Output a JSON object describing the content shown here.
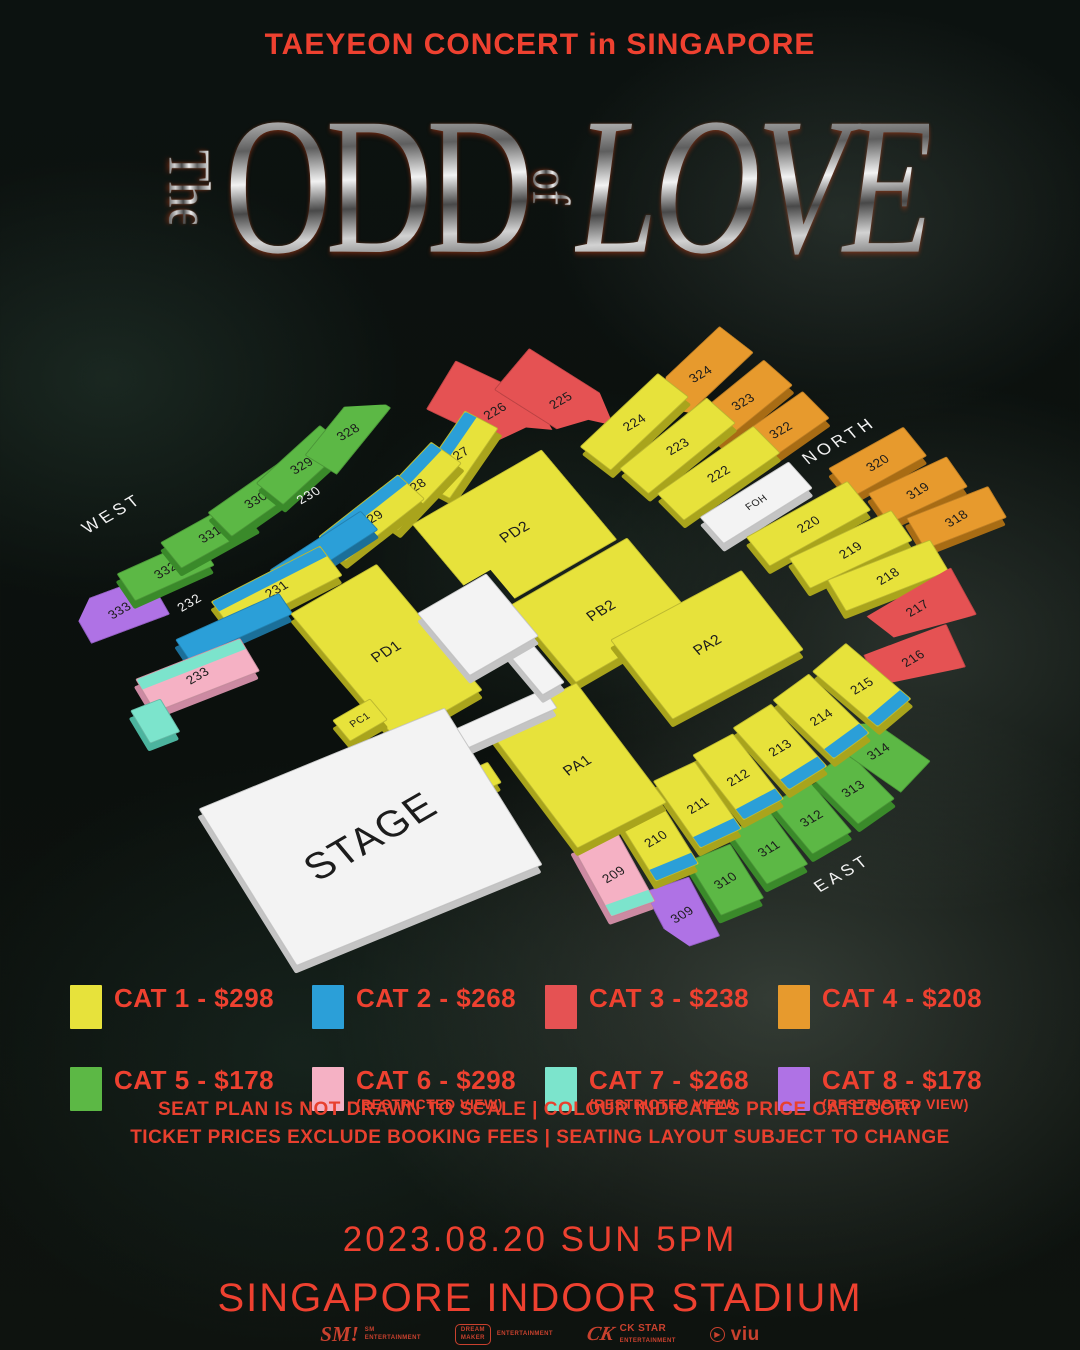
{
  "header": {
    "title": "TAEYEON CONCERT in SINGAPORE",
    "logo": {
      "the": "The",
      "odd": "ODD",
      "of": "of",
      "love": "LOVE"
    }
  },
  "map": {
    "compass": {
      "west": "WEST",
      "north": "NORTH",
      "east": "EAST"
    },
    "floating_labels": [
      {
        "text": "WEST",
        "x": -245,
        "y": -335,
        "size": 17,
        "ls": 4
      },
      {
        "text": "NORTH",
        "x": 368,
        "y": -30,
        "size": 17,
        "ls": 4
      },
      {
        "text": "EAST",
        "x": 88,
        "y": 352,
        "size": 17,
        "ls": 4
      },
      {
        "text": "230",
        "x": -80,
        "y": -252,
        "size": 13,
        "ls": 1
      },
      {
        "text": "232",
        "x": -243,
        "y": -218,
        "size": 13,
        "ls": 1
      }
    ],
    "sections": [
      {
        "id": "333",
        "label": "333",
        "cat": "8",
        "x": -302,
        "y": -247,
        "w": 82,
        "h": 46,
        "rot": 10,
        "clip": "cut-tl"
      },
      {
        "id": "332",
        "label": "332",
        "cat": "5",
        "x": -240,
        "y": -259,
        "w": 86,
        "h": 34,
        "rot": 6
      },
      {
        "id": "331",
        "label": "331",
        "cat": "5",
        "x": -182,
        "y": -268,
        "w": 90,
        "h": 34,
        "rot": 1
      },
      {
        "id": "330",
        "label": "330",
        "cat": "5",
        "x": -124,
        "y": -275,
        "w": 90,
        "h": 34,
        "rot": -5
      },
      {
        "id": "329",
        "label": "329",
        "cat": "5",
        "x": -66,
        "y": -282,
        "w": 90,
        "h": 34,
        "rot": -12
      },
      {
        "id": "328",
        "label": "328",
        "cat": "5",
        "x": -8,
        "y": -288,
        "w": 92,
        "h": 36,
        "rot": -20,
        "clip": "taper-r"
      },
      {
        "id": "324",
        "label": "324",
        "cat": "4",
        "x": 304,
        "y": -160,
        "w": 104,
        "h": 42,
        "rot": -13,
        "clip": "pent-l"
      },
      {
        "id": "323",
        "label": "323",
        "cat": "4",
        "x": 319,
        "y": -114,
        "w": 94,
        "h": 38,
        "rot": -9
      },
      {
        "id": "322",
        "label": "322",
        "cat": "4",
        "x": 330,
        "y": -70,
        "w": 88,
        "h": 38,
        "rot": -5
      },
      {
        "id": "320",
        "label": "320",
        "cat": "4",
        "x": 384,
        "y": 8,
        "w": 86,
        "h": 38,
        "rot": 1
      },
      {
        "id": "319",
        "label": "319",
        "cat": "4",
        "x": 397,
        "y": 53,
        "w": 86,
        "h": 38,
        "rot": 5
      },
      {
        "id": "318",
        "label": "318",
        "cat": "4",
        "x": 409,
        "y": 97,
        "w": 86,
        "h": 38,
        "rot": 9
      },
      {
        "id": "226",
        "label": "226",
        "cat": "3",
        "x": 120,
        "y": -232,
        "w": 62,
        "h": 112,
        "rot": -27,
        "clip": "tip-b"
      },
      {
        "id": "225",
        "label": "225",
        "cat": "3",
        "x": 178,
        "y": -208,
        "w": 58,
        "h": 110,
        "rot": -19,
        "clip": "tip-b"
      },
      {
        "id": "224",
        "label": "224",
        "cat": "1",
        "x": 221,
        "y": -151,
        "w": 112,
        "h": 38,
        "rot": -13
      },
      {
        "id": "223",
        "label": "223",
        "cat": "1",
        "x": 239,
        "y": -108,
        "w": 116,
        "h": 38,
        "rot": -9
      },
      {
        "id": "222",
        "label": "222",
        "cat": "1",
        "x": 253,
        "y": -63,
        "w": 120,
        "h": 38,
        "rot": -5
      },
      {
        "id": "FOH",
        "label": "FOH",
        "cat": "white",
        "x": 263,
        "y": -18,
        "w": 106,
        "h": 36,
        "rot": -2,
        "fs": 10
      },
      {
        "id": "220",
        "label": "220",
        "cat": "1",
        "x": 290,
        "y": 27,
        "w": 116,
        "h": 38,
        "rot": 1
      },
      {
        "id": "219",
        "label": "219",
        "cat": "1",
        "x": 306,
        "y": 71,
        "w": 112,
        "h": 38,
        "rot": 5
      },
      {
        "id": "218",
        "label": "218",
        "cat": "1",
        "x": 318,
        "y": 113,
        "w": 108,
        "h": 38,
        "rot": 9
      },
      {
        "id": "227",
        "label": "227",
        "cat": "1",
        "x": 62,
        "y": -212,
        "w": 92,
        "h": 36,
        "rot": -24,
        "band": "top",
        "bandCat": "2"
      },
      {
        "id": "228",
        "label": "228",
        "cat": "1",
        "x": 8,
        "y": -206,
        "w": 98,
        "h": 36,
        "rot": -16,
        "band": "top",
        "bandCat": "2"
      },
      {
        "id": "229",
        "label": "229",
        "cat": "1",
        "x": -46,
        "y": -200,
        "w": 104,
        "h": 36,
        "rot": -8,
        "band": "top",
        "bandCat": "2"
      },
      {
        "id": "230",
        "cat": "2",
        "x": -104,
        "y": -196,
        "w": 110,
        "h": 26,
        "rot": -3
      },
      {
        "id": "231",
        "label": "231",
        "cat": "1",
        "x": -166,
        "y": -186,
        "w": 122,
        "h": 38,
        "rot": 3,
        "band": "top",
        "bandCat": "2"
      },
      {
        "id": "232",
        "cat": "2",
        "x": -224,
        "y": -174,
        "w": 112,
        "h": 26,
        "rot": 6
      },
      {
        "id": "233",
        "label": "233",
        "cat": "6",
        "x": -284,
        "y": -150,
        "w": 110,
        "h": 40,
        "rot": 9,
        "band": "top",
        "bandCat": "7"
      },
      {
        "id": "west-restricted",
        "cat": "7",
        "x": -347,
        "y": -131,
        "w": 32,
        "h": 40,
        "rot": 9
      },
      {
        "id": "217",
        "label": "217",
        "cat": "3",
        "x": 320,
        "y": 156,
        "w": 96,
        "h": 56,
        "rot": 11,
        "clip": "tip-l"
      },
      {
        "id": "216",
        "label": "216",
        "cat": "3",
        "x": 284,
        "y": 198,
        "w": 86,
        "h": 50,
        "rot": 15,
        "clip": "tip-l2"
      },
      {
        "id": "309",
        "label": "309",
        "cat": "8",
        "x": -63,
        "y": 306,
        "w": 46,
        "h": 70,
        "rot": 12,
        "clip": "cut-bl"
      },
      {
        "id": "310",
        "label": "310",
        "cat": "5",
        "x": -7,
        "y": 298,
        "w": 46,
        "h": 66,
        "rot": 8
      },
      {
        "id": "311",
        "label": "311",
        "cat": "5",
        "x": 47,
        "y": 292,
        "w": 46,
        "h": 66,
        "rot": 4
      },
      {
        "id": "312",
        "label": "312",
        "cat": "5",
        "x": 100,
        "y": 287,
        "w": 46,
        "h": 66,
        "rot": 0
      },
      {
        "id": "313",
        "label": "313",
        "cat": "5",
        "x": 152,
        "y": 282,
        "w": 46,
        "h": 66,
        "rot": -5
      },
      {
        "id": "314",
        "label": "314",
        "cat": "5",
        "x": 196,
        "y": 262,
        "w": 46,
        "h": 88,
        "rot": -16,
        "clip": "pent-t"
      },
      {
        "id": "215",
        "label": "215",
        "cat": "1",
        "x": 226,
        "y": 196,
        "w": 46,
        "h": 84,
        "rot": -10,
        "band": "bottom",
        "bandCat": "2"
      },
      {
        "id": "214",
        "label": "214",
        "cat": "1",
        "x": 174,
        "y": 203,
        "w": 46,
        "h": 84,
        "rot": -6,
        "band": "bottom",
        "bandCat": "2"
      },
      {
        "id": "213",
        "label": "213",
        "cat": "1",
        "x": 122,
        "y": 209,
        "w": 46,
        "h": 84,
        "rot": -2,
        "band": "bottom",
        "bandCat": "2"
      },
      {
        "id": "212",
        "label": "212",
        "cat": "1",
        "x": 70,
        "y": 214,
        "w": 46,
        "h": 84,
        "rot": 2,
        "band": "bottom",
        "bandCat": "2"
      },
      {
        "id": "211",
        "label": "211",
        "cat": "1",
        "x": 20,
        "y": 218,
        "w": 46,
        "h": 84,
        "rot": 5,
        "band": "bottom",
        "bandCat": "2"
      },
      {
        "id": "210",
        "label": "210",
        "cat": "1",
        "x": -34,
        "y": 226,
        "w": 46,
        "h": 84,
        "rot": 8,
        "band": "bottom",
        "bandCat": "2"
      },
      {
        "id": "209",
        "label": "209",
        "cat": "6",
        "x": -90,
        "y": 236,
        "w": 46,
        "h": 84,
        "rot": 11,
        "band": "bottom",
        "bandCat": "7"
      },
      {
        "id": "PD1",
        "label": "PD1",
        "cat": "1",
        "x": -122,
        "y": -75,
        "w": 100,
        "h": 165,
        "rot": 0,
        "fs": 15
      },
      {
        "id": "PD2",
        "label": "PD2",
        "cat": "1",
        "x": 56,
        "y": -115,
        "w": 150,
        "h": 118,
        "rot": 0,
        "clip": "notch-bl",
        "fs": 15
      },
      {
        "id": "PB2",
        "label": "PB2",
        "cat": "1",
        "x": 72,
        "y": -2,
        "w": 135,
        "h": 102,
        "rot": 0,
        "fs": 15
      },
      {
        "id": "PA2",
        "label": "PA2",
        "cat": "1",
        "x": 132,
        "y": 82,
        "w": 148,
        "h": 102,
        "rot": 2,
        "fs": 15
      },
      {
        "id": "PA1",
        "label": "PA1",
        "cat": "1",
        "x": -48,
        "y": 122,
        "w": 100,
        "h": 152,
        "rot": 3,
        "fs": 15
      },
      {
        "id": "PC1",
        "label": "PC1",
        "cat": "1",
        "x": -187,
        "y": -28,
        "w": 44,
        "h": 28,
        "rot": 0,
        "fs": 10
      },
      {
        "id": "runway",
        "cat": "white",
        "x": -80,
        "y": 44,
        "w": 112,
        "h": 24,
        "rot": 6
      },
      {
        "id": "catwalk-bar",
        "cat": "white",
        "x": -16,
        "y": 0,
        "w": 26,
        "h": 86,
        "rot": 0
      },
      {
        "id": "catwalk-platform",
        "cat": "white",
        "x": -33,
        "y": -52,
        "w": 80,
        "h": 82,
        "rot": 0
      },
      {
        "id": "PB1",
        "label": "PB1",
        "cat": "1",
        "x": -138,
        "y": 84,
        "w": 44,
        "h": 26,
        "rot": 6,
        "fs": 10
      },
      {
        "id": "stage",
        "label": "STAGE",
        "cat": "white",
        "x": -255,
        "y": 80,
        "w": 260,
        "h": 190,
        "rot": 8,
        "fs": 40
      }
    ]
  },
  "legend": {
    "items": [
      {
        "label": "CAT 1 - $298",
        "color": "#e7e23b"
      },
      {
        "label": "CAT 2 - $268",
        "color": "#2b9fd8"
      },
      {
        "label": "CAT 3 - $238",
        "color": "#e55253"
      },
      {
        "label": "CAT 4 - $208",
        "color": "#e79a2d"
      },
      {
        "label": "CAT 5 - $178",
        "color": "#5cb845"
      },
      {
        "label": "CAT 6 - $298",
        "sub": "(RESTRICTED VIEW)",
        "color": "#f5b1c4"
      },
      {
        "label": "CAT 7 - $268",
        "sub": "(RESTRICTED VIEW)",
        "color": "#7ce4cc"
      },
      {
        "label": "CAT 8 - $178",
        "sub": "(RESTRICTED VIEW)",
        "color": "#af72e5"
      }
    ]
  },
  "notes": {
    "line1": "SEAT PLAN IS NOT DRAWN TO SCALE | COLOUR INDICATES PRICE CATEGORY",
    "line2": "TICKET PRICES EXCLUDE BOOKING FEES | SEATING LAYOUT SUBJECT TO CHANGE"
  },
  "footer": {
    "date": "2023.08.20 SUN 5PM",
    "venue": "SINGAPORE INDOOR STADIUM",
    "sponsors": {
      "sm": {
        "mark": "SM!",
        "line1": "SM",
        "line2": "ENTERTAINMENT"
      },
      "dream": {
        "line1": "DREAM",
        "line2": "MAKER",
        "line3": "ENTERTAINMENT"
      },
      "ck": {
        "mark": "CK",
        "line1": "CK STAR",
        "line2": "ENTERTAINMENT"
      },
      "viu": {
        "play": "▶",
        "name": "viu"
      }
    }
  },
  "accent_colors": {
    "text_red": "#ee4130",
    "background": "#0c1210"
  }
}
